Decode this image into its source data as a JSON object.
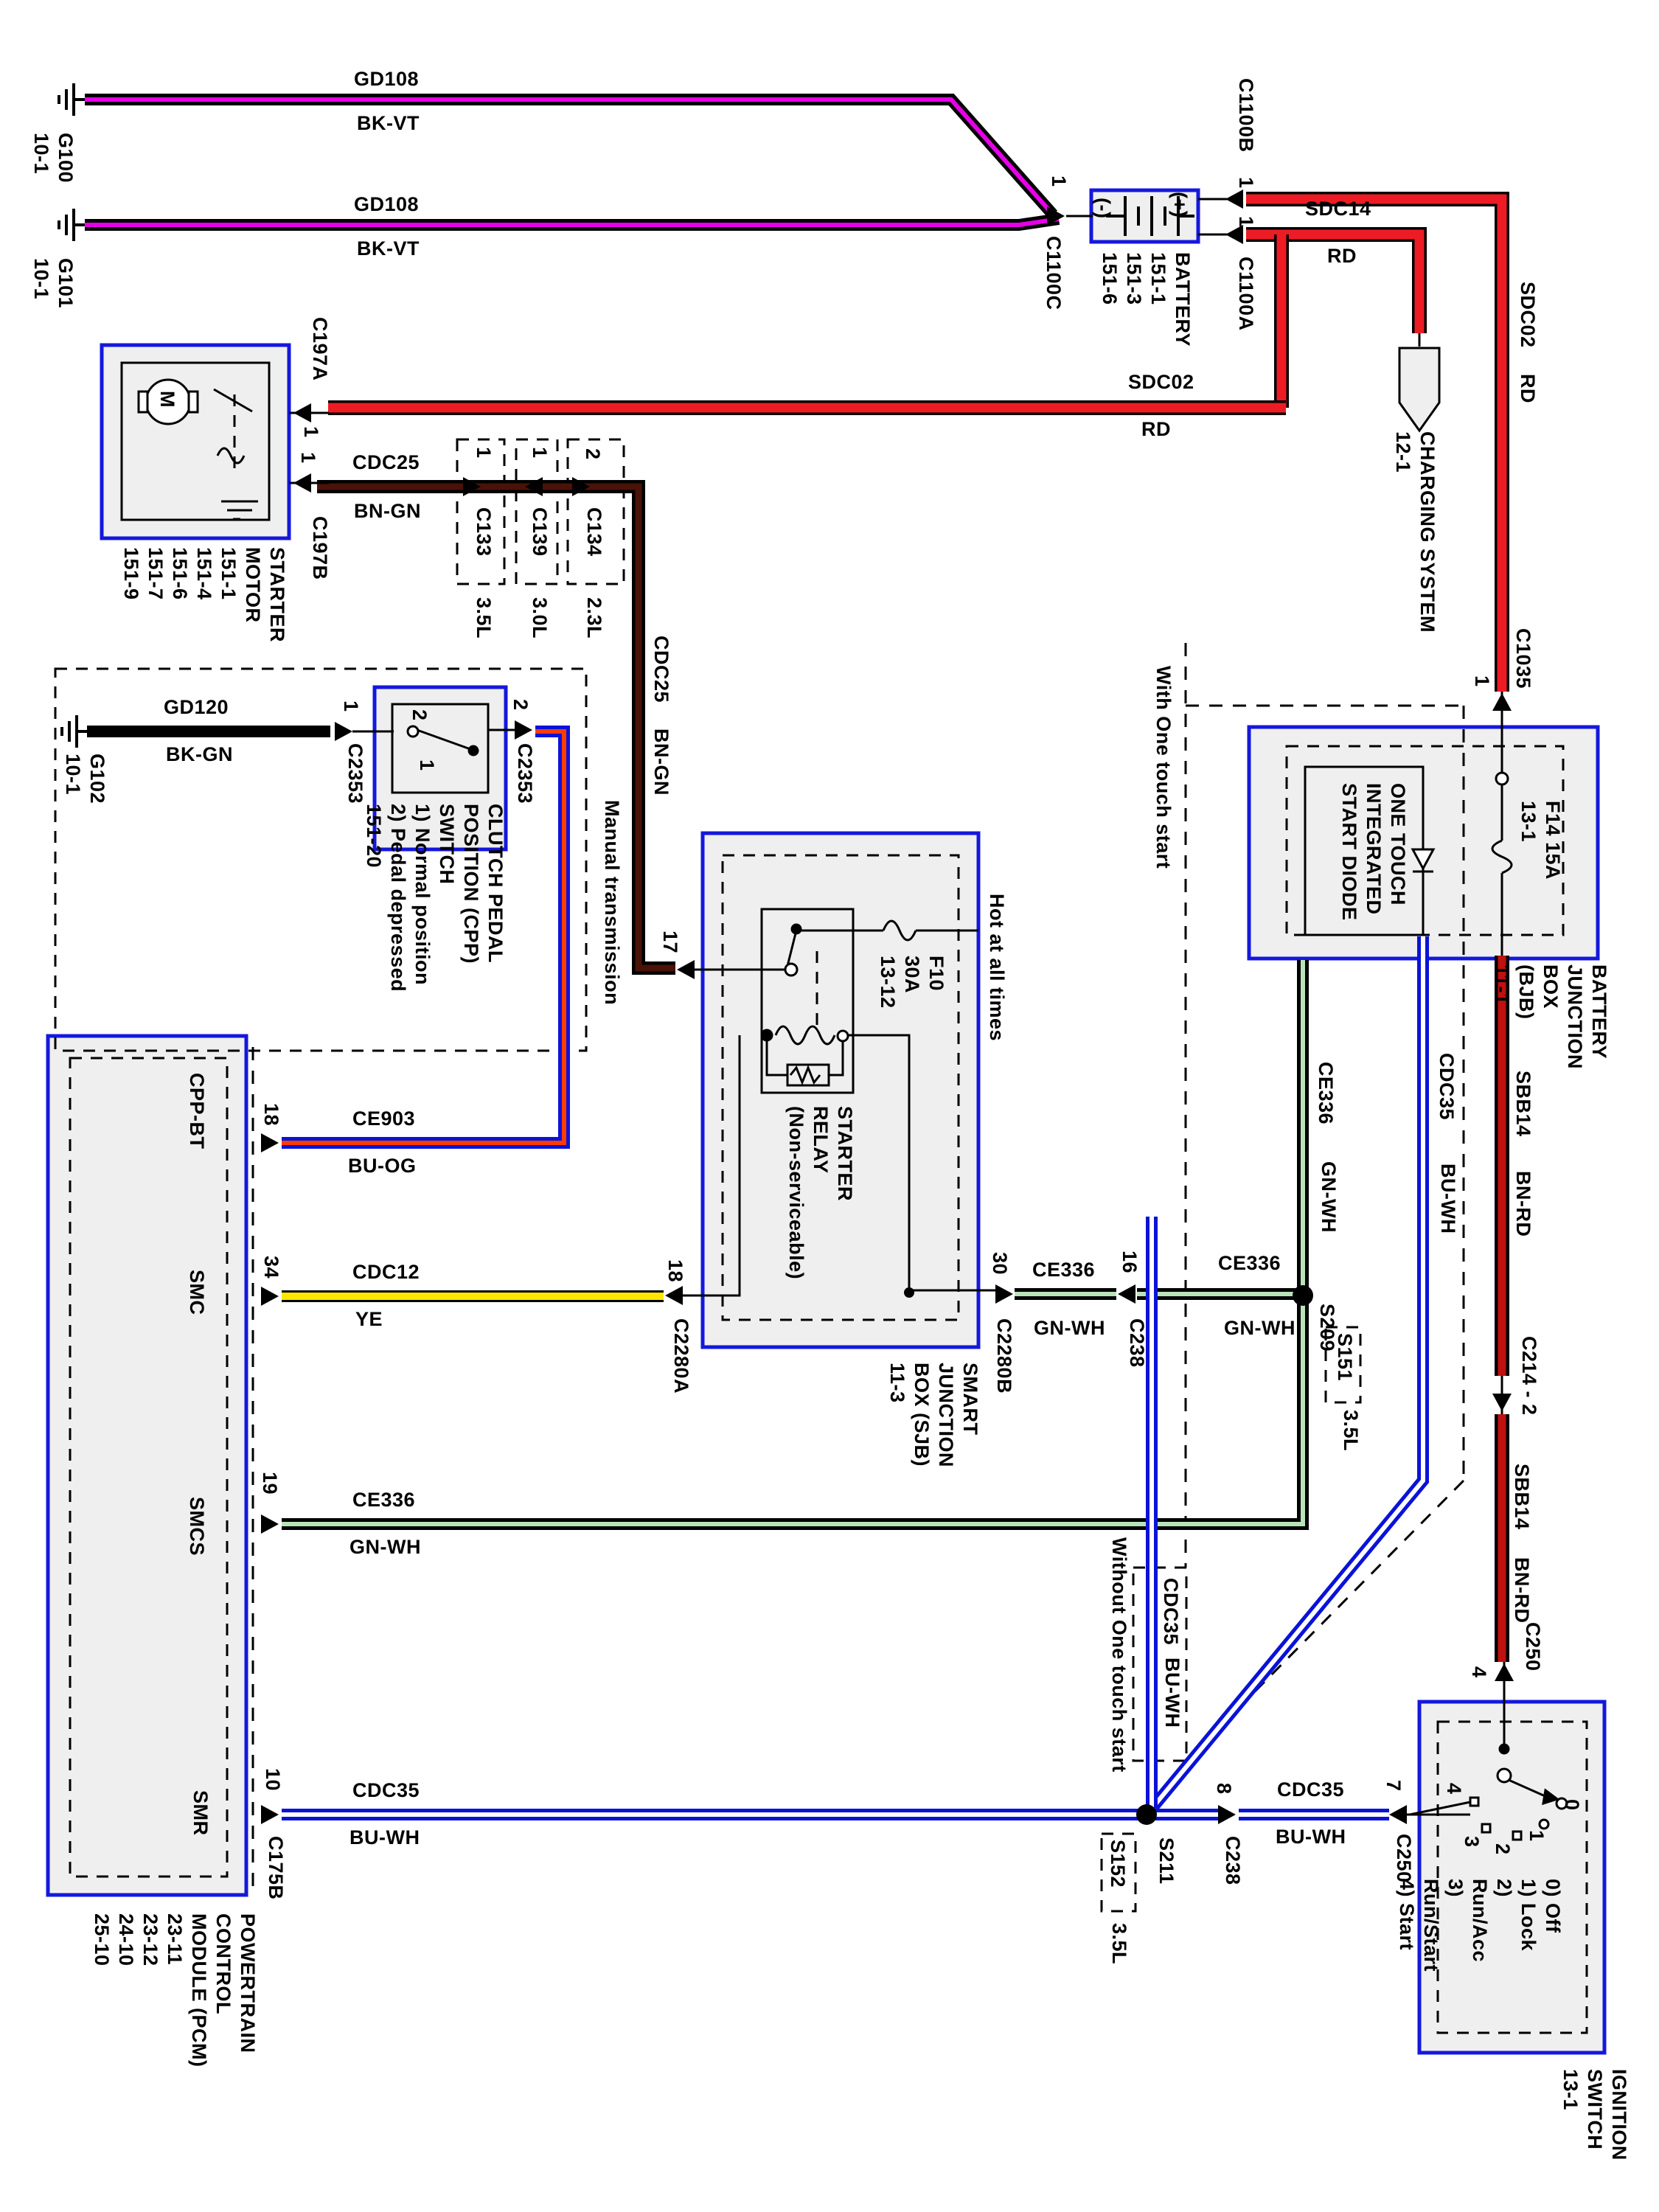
{
  "diagram_type": "automotive starting system wiring diagram",
  "colors": {
    "box_border": "#1418dc",
    "box_fill": "#efefef",
    "wire_red": "#ed1c24",
    "wire_brown_red": "#c01010",
    "wire_violet": "#e800e8",
    "wire_brown_green": "#4a1208",
    "wire_yellow": "#ffe600",
    "wire_orange": "#ff3c00",
    "wire_green_white": "#b9e4b9",
    "wire_blue": "#0a12d8",
    "wire_white": "#ffffff"
  },
  "labels": {
    "g100": "G100\n10-1",
    "g101": "G101\n10-1",
    "g102": "G102\n10-1",
    "gd108a_name": "GD108",
    "gd108a_color": "BK-VT",
    "gd108b_name": "GD108",
    "gd108b_color": "BK-VT",
    "gd120_name": "GD120",
    "gd120_color": "BK-GN",
    "sdc02_name": "SDC02",
    "sdc02_color": "RD",
    "sdc02v_name": "SDC02",
    "sdc02v_color": "RD",
    "sdc14_name": "SDC14",
    "sdc14_color": "RD",
    "cdc25_name": "CDC25",
    "cdc25_color": "BN-GN",
    "cdc25v_name": "CDC25",
    "cdc25v_color": "BN-GN",
    "ce903_name": "CE903",
    "ce903_color": "BU-OG",
    "cdc12_name": "CDC12",
    "cdc12_color": "YE",
    "ce336a_name": "CE336",
    "ce336a_color": "GN-WH",
    "ce336b_name": "CE336",
    "ce336b_color": "GN-WH",
    "ce336c_name": "CE336",
    "ce336c_color": "GN-WH",
    "ce336v_name": "CE336",
    "ce336v_color": "GN-WH",
    "cdc35a_name": "CDC35",
    "cdc35a_color": "BU-WH",
    "cdc35b_name": "CDC35",
    "cdc35b_color": "BU-WH",
    "cdc35v_name": "CDC35",
    "cdc35v_color": "BU-WH",
    "cdc35l_name": "CDC35",
    "cdc35l_color": "BU-WH",
    "sbb14a_name": "SBB14",
    "sbb14a_color": "BN-RD",
    "sbb14b_name": "SBB14",
    "sbb14b_color": "BN-RD",
    "c1100b": "C1100B",
    "c1100a": "C1100A",
    "c1100c": "C1100C",
    "c197a": "C197A",
    "c197b": "C197B",
    "c133": "C133",
    "c139": "C139",
    "c134": "C134",
    "e35": "3.5L",
    "e30": "3.0L",
    "e23": "2.3L",
    "c2353l": "C2353",
    "c2353r": "C2353",
    "c2280a": "C2280A",
    "c2280b": "C2280B",
    "c238a": "C238",
    "c238b": "C238",
    "c250a": "C250",
    "c250b": "C250",
    "c214": "C214 - 2",
    "c1035": "C1035",
    "c175b": "C175B",
    "s209": "S209",
    "s151": "S151",
    "s151e": "3.5L",
    "s211": "S211",
    "s152": "S152",
    "s152e": "3.5L",
    "battery_minus": "(-)",
    "battery_plus": "(+)",
    "battery_name": "BATTERY\n151-1\n151-3\n151-6",
    "starter_name": "STARTER\nMOTOR\n151-1\n151-4\n151-6\n151-7\n151-9",
    "motor_m": "M",
    "cpp_name": "CLUTCH PEDAL\nPOSITION (CPP)\nSWITCH\n1) Normal position\n2) Pedal depressed\n151-20",
    "cpp_in2": "2",
    "cpp_in1": "1",
    "manual": "Manual transmission",
    "charging": "CHARGING SYSTEM\n12-1",
    "hot": "Hot at all times",
    "f10": "F10\n30A\n13-12",
    "relay": "STARTER\nRELAY\n(Non-serviceable)",
    "sjb": "SMART\nJUNCTION\nBOX (SJB)\n11-3",
    "bjb": "BATTERY JUNCTION\nBOX (BJB)\n11-1",
    "f14": "F14  15A\n13-1",
    "diode": "ONE TOUCH\nINTEGRATED\nSTART DIODE",
    "pcm": "POWERTRAIN\nCONTROL\nMODULE (PCM)\n23-11\n23-12\n24-10\n25-10",
    "cpp_bt": "CPP-BT",
    "smc": "SMC",
    "smcs": "SMCS",
    "smr": "SMR",
    "ign": "IGNITION\nSWITCH\n13-1",
    "ign_legend": "0) Off\n1) Lock\n2) Run/Acc\n3) Run/Start\n4) Start",
    "ign0": "0",
    "ign1": "1",
    "ign2": "2",
    "ign3": "3",
    "ign4": "4",
    "with_ots": "With One touch start",
    "without_ots": "Without One touch start",
    "pin1_c1100c": "1",
    "pin1_c1100b": "1",
    "pin1_c1100a": "1",
    "pin1_c197a": "1",
    "pin1_c197b": "1",
    "pin1_c133": "1",
    "pin1_c139": "1",
    "pin2_c134": "2",
    "pin1_c2353l": "1",
    "pin2_c2353r": "2",
    "pin17": "17",
    "pin18_pcm": "18",
    "pin18_sjb": "18",
    "pin34": "34",
    "pin19": "19",
    "pin10": "10",
    "pin30": "30",
    "pin16": "16",
    "pin8": "8",
    "pin7": "7",
    "pin4": "4",
    "pin1_c1035": "1"
  }
}
